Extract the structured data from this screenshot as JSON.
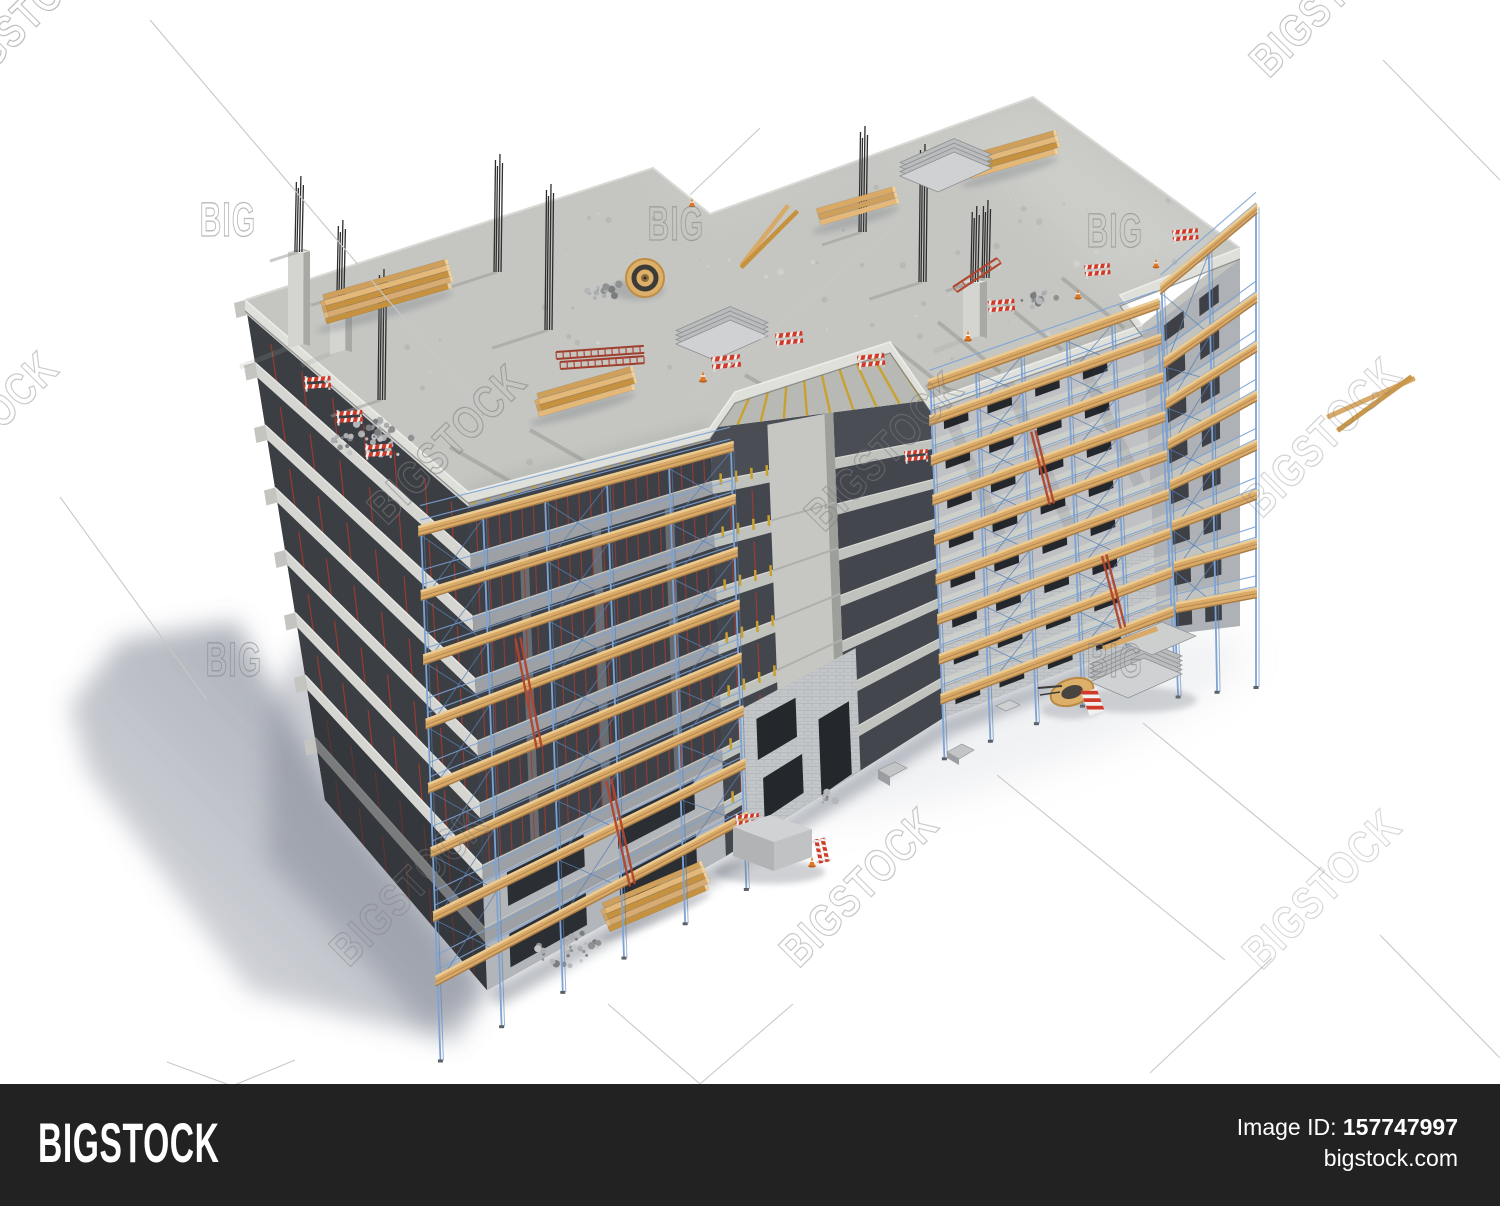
{
  "page": {
    "type": "stock-photo-preview",
    "background": "#ffffff"
  },
  "subject": {
    "description": "3D render of an apartment building under construction with scaffolding, viewed from above",
    "floors_visible": 8
  },
  "watermark": {
    "brand_tile": "BIGSTOCK",
    "brand_short": "BIG"
  },
  "footer": {
    "logo": "BIGSTOCK",
    "image_id_label": "Image ID:",
    "image_id": "157747997",
    "site": "bigstock.com",
    "bar_color": "#222222",
    "text_color": "#ffffff"
  },
  "colors": {
    "roof": "#c5c6c2",
    "roof_light": "#d3d4cf",
    "slab_edge": "#dfe0da",
    "slab_band": "#cdcfca",
    "band_shade": "#9da1a5",
    "wall": "#bfc1c4",
    "wall_brick": "#c3c6c9",
    "wall_shade": "#aeb1b5",
    "interior": "#3d4147",
    "interior2": "#4a4e54",
    "window": "#24272c",
    "scaffold": "#7ca3d6",
    "scaffold_dark": "#5a80b2",
    "wood": "#d8a967",
    "wood_light": "#eccb92",
    "wood_dark": "#a87b45",
    "joist": "#c9a12f",
    "prop": "#a33b2e",
    "rebar": "#2d2d2d",
    "red": "#cf3a2a",
    "white": "#f2f1ee",
    "orange": "#e2731f",
    "gravel": "#9da0a2",
    "panel": "#c9cacb",
    "shadow": "#6e7585",
    "wm_stroke": "#7f7f7f",
    "wm_line": "#c8c8c8"
  },
  "scene_objects": [
    "building-under-construction",
    "roof-slab",
    "rebar-column-starters",
    "concrete-column-stubs",
    "lumber-stacks",
    "cable-spool",
    "formwork-panel-stacks",
    "ladders",
    "traffic-barriers",
    "traffic-cones",
    "gravel-piles",
    "scaffolding-with-walkways",
    "open-floor-notch",
    "brick-walls-with-windows",
    "ground-equipment",
    "building-shadow"
  ]
}
